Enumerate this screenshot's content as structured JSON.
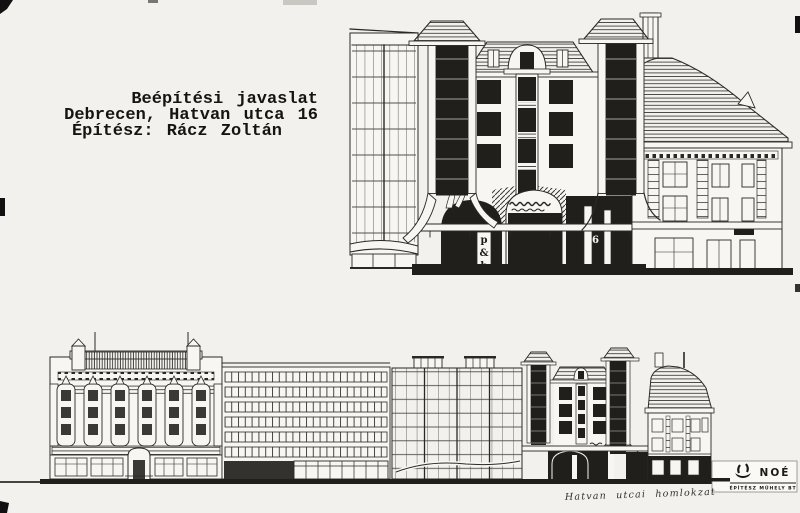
{
  "page": {
    "background": "#f2f1ed",
    "ink": "#2b2925",
    "dark_fill": "#211f1c"
  },
  "title_block": {
    "line1": "Beépítési javaslat",
    "line2": "Debrecen, Hatvan utca 16",
    "line3": "Építész: Rácz Zoltán"
  },
  "detail_elevation": {
    "shop_sign": [
      "p",
      "&",
      "b"
    ],
    "house_number": "16"
  },
  "street_elevation": {
    "caption": "Hatvan utcai homlokzat"
  },
  "stamp": {
    "icon": "ark-boat-icon",
    "name": "NOÉ",
    "subtitle": "ÉPÍTÉSZ MŰHELY BT"
  }
}
